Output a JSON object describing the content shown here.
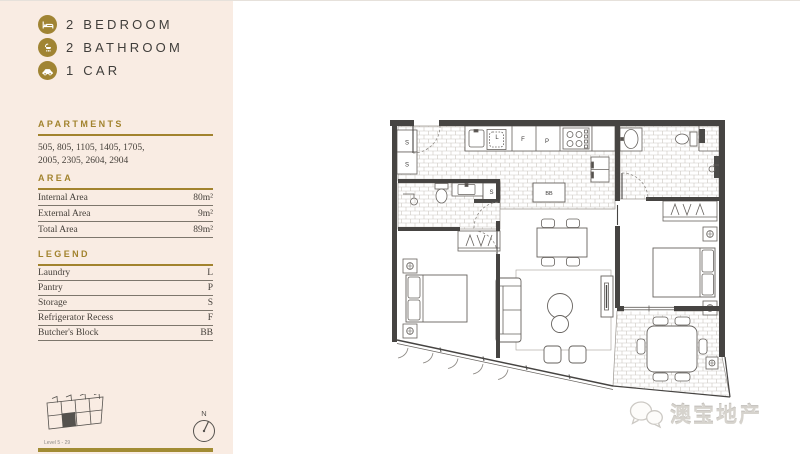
{
  "sidebar": {
    "summary": [
      {
        "icon": "bed-icon",
        "label": "2 BEDROOM"
      },
      {
        "icon": "shower-icon",
        "label": "2 BATHROOM"
      },
      {
        "icon": "car-icon",
        "label": "1 CAR"
      }
    ],
    "apartments": {
      "heading": "APARTMENTS",
      "line1": "505, 805, 1105, 1405, 1705,",
      "line2": "2005, 2305, 2604, 2904"
    },
    "area": {
      "heading": "AREA",
      "rows": [
        {
          "label": "Internal Area",
          "value": "80m²"
        },
        {
          "label": "External Area",
          "value": "9m²"
        },
        {
          "label": "Total Area",
          "value": "89m²"
        }
      ]
    },
    "legend": {
      "heading": "LEGEND",
      "rows": [
        {
          "label": "Laundry",
          "code": "L"
        },
        {
          "label": "Pantry",
          "code": "P"
        },
        {
          "label": "Storage",
          "code": "S"
        },
        {
          "label": "Refrigerator Recess",
          "code": "F"
        },
        {
          "label": "Butcher's Block",
          "code": "BB"
        }
      ]
    },
    "keyplan_caption": "Level 5 - 29",
    "compass_label": "N"
  },
  "floorplan": {
    "labels": {
      "storage_a": "S",
      "storage_b": "S",
      "laundry": "L",
      "fridge": "F",
      "pantry": "P",
      "storage_c": "S",
      "butchers_block": "BB"
    }
  },
  "watermark": {
    "text": "澳宝地产"
  },
  "colors": {
    "accent_gold": "#a2832e",
    "sidebar_bg": "#f9ece3",
    "text_dark": "#403e3b",
    "wall": "#464442"
  }
}
